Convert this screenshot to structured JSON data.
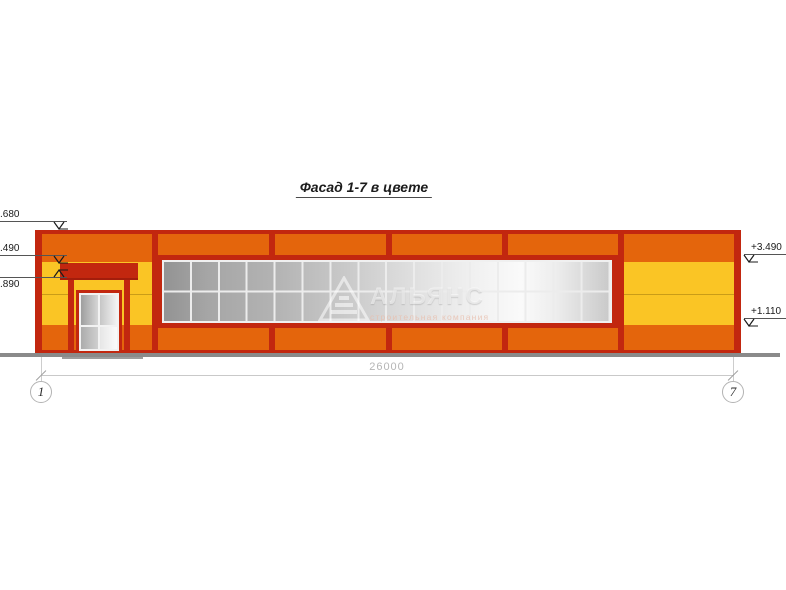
{
  "drawing": {
    "title": "Фасад 1-7 в цвете"
  },
  "colors": {
    "wall_orange": "#E4650C",
    "frame_dark_red": "#C2270F",
    "panel_yellow": "#FAC525",
    "glazing_gray": "#C9C9C9",
    "ground_gray": "#8A8A8A",
    "annotation_gray": "#C9C9C9"
  },
  "elevation_marks": {
    "left": [
      {
        "label": ".680"
      },
      {
        "label": ".490"
      },
      {
        "label": ".890"
      }
    ],
    "right": [
      {
        "label": "+3.490"
      },
      {
        "label": "+1.110"
      }
    ]
  },
  "dimension": {
    "total_width": "26000"
  },
  "axes": [
    {
      "label": "1"
    },
    {
      "label": "7"
    }
  ],
  "watermark": {
    "brand": "АЛЬЯНС",
    "tagline": "строительная компания"
  }
}
